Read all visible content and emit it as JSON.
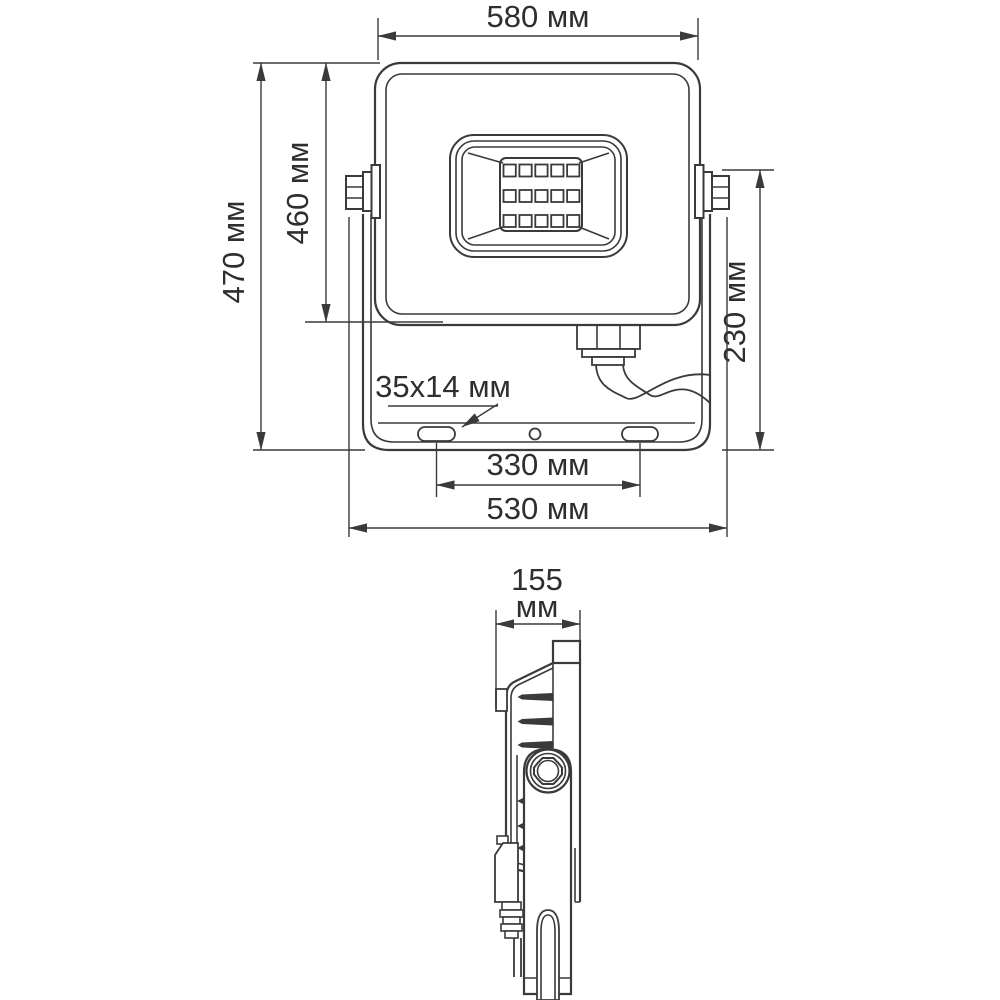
{
  "background": "#ffffff",
  "line_color": "#3a3a3c",
  "text_color": "#2e2e30",
  "views": {
    "front": {
      "label": "front-view-of-floodlight",
      "dims": {
        "width_top": "580 мм",
        "overall_height": "470 мм",
        "body_height": "460 мм",
        "bracket_height": "230 мм",
        "slot_size": "35x14 мм",
        "slot_spacing": "330 мм",
        "bracket_width": "530 мм"
      }
    },
    "side": {
      "label": "side-view-of-floodlight",
      "dims": {
        "depth_value": "155",
        "depth_unit": "мм"
      }
    }
  }
}
